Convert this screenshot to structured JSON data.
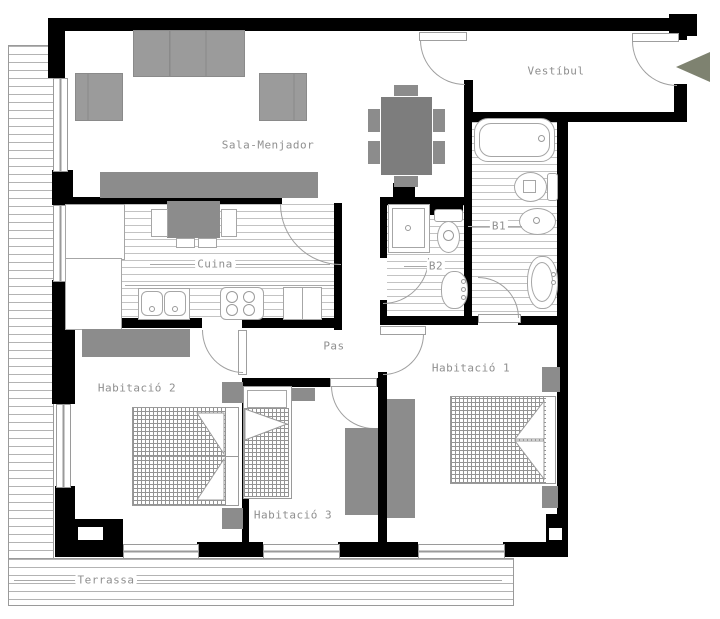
{
  "plan_title": "apartment-floor-plan",
  "labels": {
    "sala": "Sala-Menjador",
    "vestibul": "Vestíbul",
    "cuina": "Cuina",
    "pas": "Pas",
    "b1": "B1",
    "b2": "B2",
    "hab1": "Habitació 1",
    "hab2": "Habitació 2",
    "hab3": "Habitació 3",
    "terrassa": "Terrassa"
  },
  "colors": {
    "wall": "#000000",
    "furniture_gray": "#8c8c8c",
    "sofa_gray": "#9b9b9b",
    "table_gray": "#7d7d7d",
    "label_text": "#8f8f8f",
    "thin_line": "#9f9f9f",
    "entry_arrow": "#7e8270",
    "background": "#ffffff"
  }
}
